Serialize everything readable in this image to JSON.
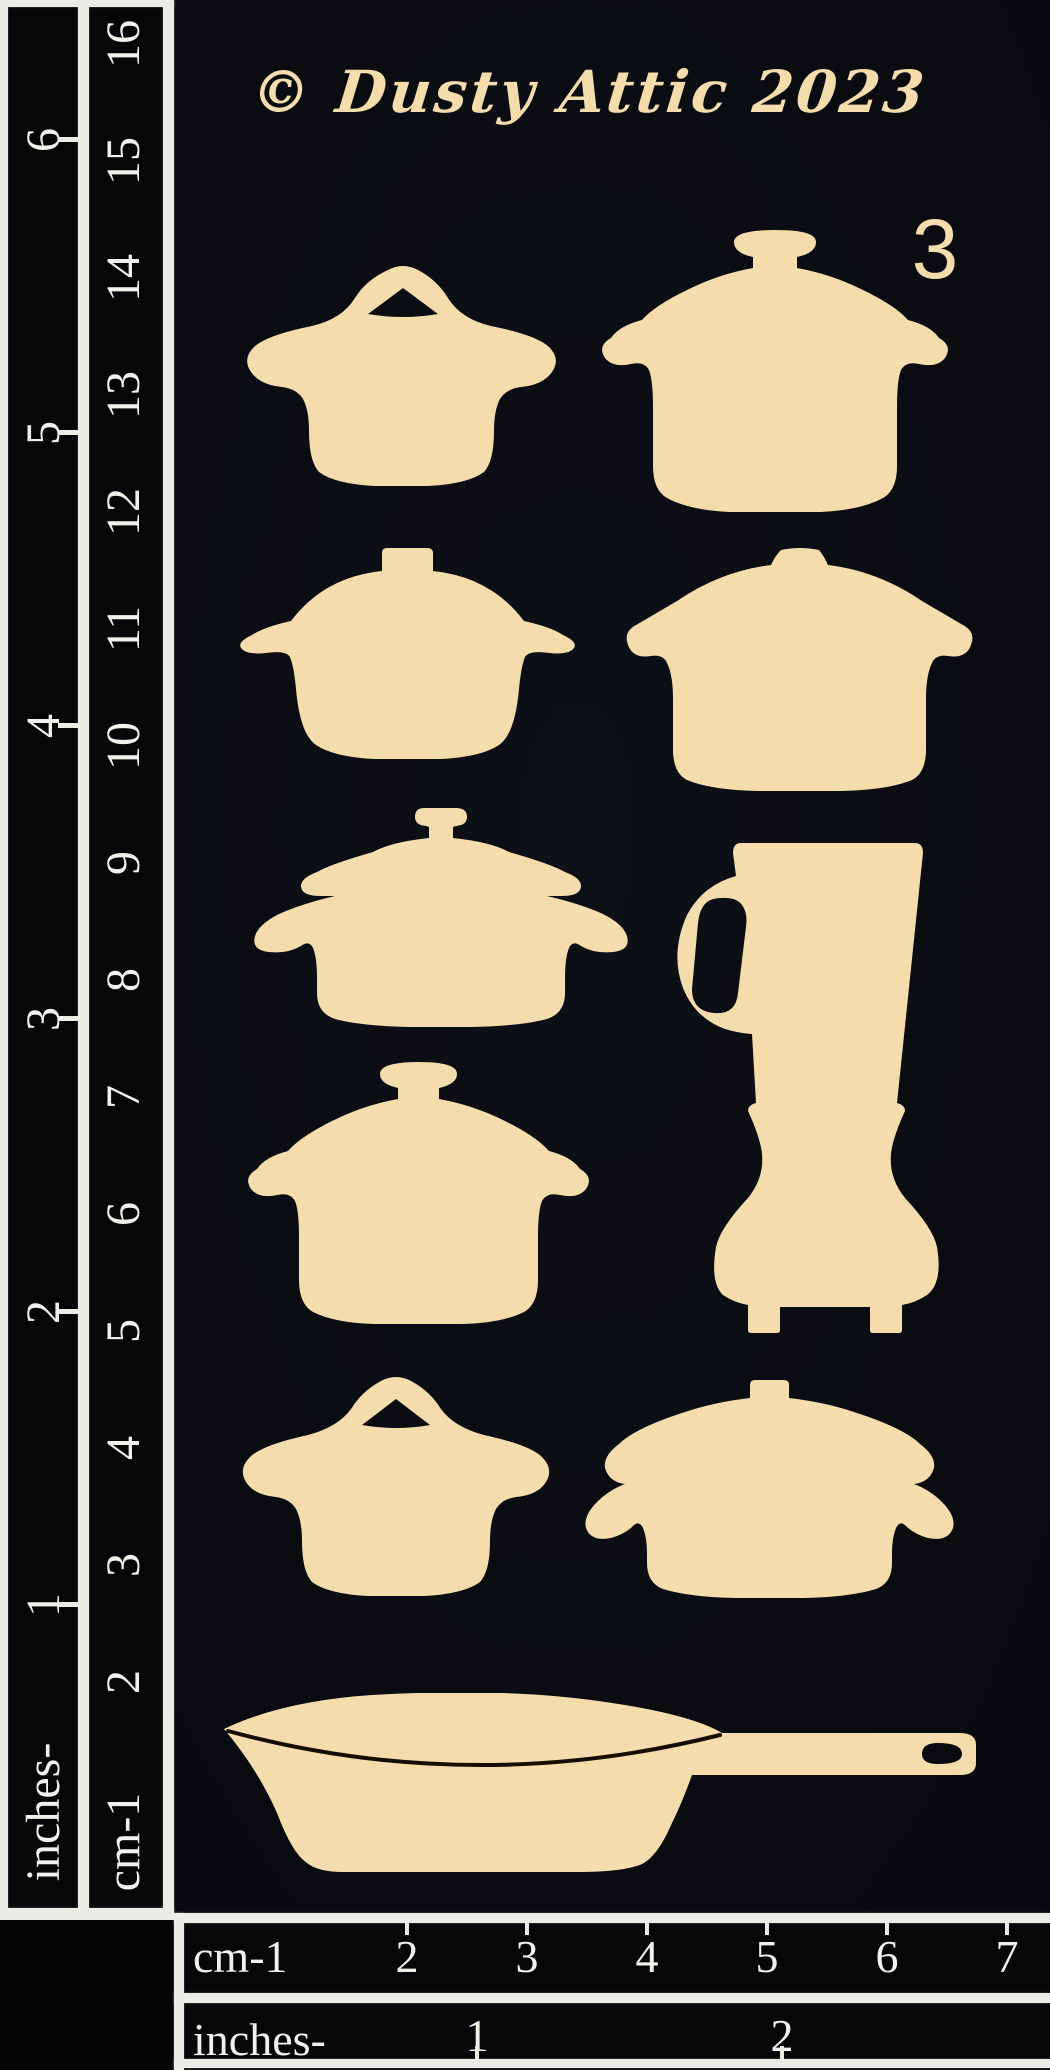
{
  "header": {
    "copyright_line": "© Dusty Attic 2023",
    "sheet_number": "3"
  },
  "colors": {
    "chipboard": "#f5dcad",
    "sheet_background": "#0a0c10",
    "ruler_background": "#060708",
    "ruler_markings": "#ecebe6",
    "skillet_rim_line": "#140e06"
  },
  "left_ruler": {
    "inches_label": "inches-",
    "cm_label": "cm-1",
    "inch_numbers": [
      "1",
      "2",
      "3",
      "4",
      "5",
      "6"
    ],
    "cm_numbers": [
      "2",
      "3",
      "4",
      "5",
      "6",
      "7",
      "8",
      "9",
      "10",
      "11",
      "12",
      "13",
      "14",
      "15",
      "16"
    ]
  },
  "bottom_ruler": {
    "cm_label": "cm-1",
    "cm_numbers": [
      "2",
      "3",
      "4",
      "5",
      "6",
      "7"
    ],
    "inches_label": "inches-",
    "inch_numbers": [
      "1",
      "2"
    ]
  },
  "pieces": [
    {
      "label": "pot with arched lid handle"
    },
    {
      "label": "pot with knob lid and ear handles"
    },
    {
      "label": "casserole with tab knob and wing handles"
    },
    {
      "label": "wide pot with bump knob and ear handles"
    },
    {
      "label": "casserole with flanged lid and loop handles"
    },
    {
      "label": "blender"
    },
    {
      "label": "dutch oven with knob lid and ear handles"
    },
    {
      "label": "small pot with arched lid handle"
    },
    {
      "label": "oval casserole with tab knob"
    },
    {
      "label": "skillet with long handle"
    }
  ]
}
